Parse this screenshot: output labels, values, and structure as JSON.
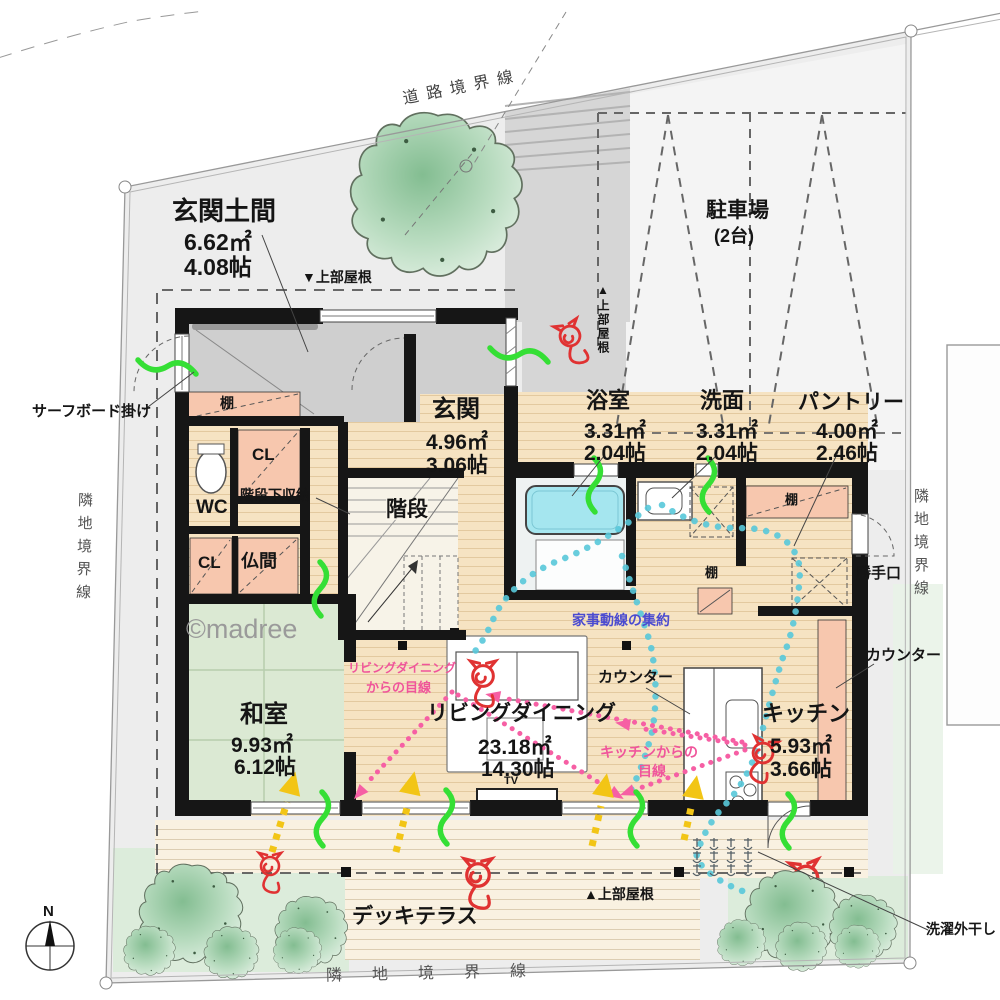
{
  "watermark": "©madree",
  "compass": {
    "north_label": "N"
  },
  "boundaries": {
    "road": "道路境界線",
    "adjacent_left": "隣地境界線",
    "adjacent_right": "隣地境界線",
    "adjacent_bottom": "隣地境界線"
  },
  "rooms": {
    "genkan_doma": {
      "name": "玄関土間",
      "area_m2": "6.62㎡",
      "area_jo": "4.08帖"
    },
    "parking": {
      "name": "駐車場",
      "capacity": "(2台)"
    },
    "bathroom": {
      "name": "浴室",
      "area_m2": "3.31㎡",
      "area_jo": "2.04帖"
    },
    "washroom": {
      "name": "洗面",
      "area_m2": "3.31㎡",
      "area_jo": "2.04帖"
    },
    "pantry": {
      "name": "パントリー",
      "area_m2": "4.00㎡",
      "area_jo": "2.46帖"
    },
    "genkan": {
      "name": "玄関",
      "area_m2": "4.96㎡",
      "area_jo": "3.06帖"
    },
    "stairs": {
      "name": "階段"
    },
    "wc": {
      "name": "WC"
    },
    "closet_upper": {
      "name": "CL"
    },
    "closet_lower": {
      "name": "CL"
    },
    "butsuma": {
      "name": "仏間"
    },
    "washitsu": {
      "name": "和室",
      "area_m2": "9.93㎡",
      "area_jo": "6.12帖"
    },
    "living_dining": {
      "name": "リビングダイニング",
      "area_m2": "23.18㎡",
      "area_jo": "14.30帖"
    },
    "kitchen": {
      "name": "キッチン",
      "area_m2": "5.93㎡",
      "area_jo": "3.66帖"
    },
    "deck": {
      "name": "デッキテラス"
    }
  },
  "annotations": {
    "surfboard": "サーフボード掛け",
    "under_stair_storage": "階段下収納",
    "shelf_doma": "棚",
    "shelf_washroom": "棚",
    "shelf_pantry": "棚",
    "roof_front": "▼上部屋根",
    "roof_side": "▲上部屋根",
    "roof_back": "▲上部屋根",
    "back_door": "勝手口",
    "counter_island": "カウンター",
    "counter_wall": "カウンター",
    "housework_line": "家事動線の集約",
    "sight_living_1": "リビングダイニング",
    "sight_living_2": "からの目線",
    "sight_kitchen_1": "キッチンからの",
    "sight_kitchen_2": "目線",
    "laundry": "洗濯外干し",
    "tv": "TV"
  },
  "colors": {
    "wall": "#161616",
    "wood_floor": "#f6e3c2",
    "tatami": "#dbe9d3",
    "doma_gray": "#cfcfcf",
    "furniture_pink": "#f7c7ae",
    "bathtub": "#a5e6ef",
    "housework_flow": "#58c8da",
    "sight_line": "#f65fa4",
    "sun_arrow": "#f2c516",
    "breeze": "#35df35",
    "red_doodle": "#e03232",
    "garden_green": "#dcecdb",
    "boundary_line": "#999999"
  }
}
